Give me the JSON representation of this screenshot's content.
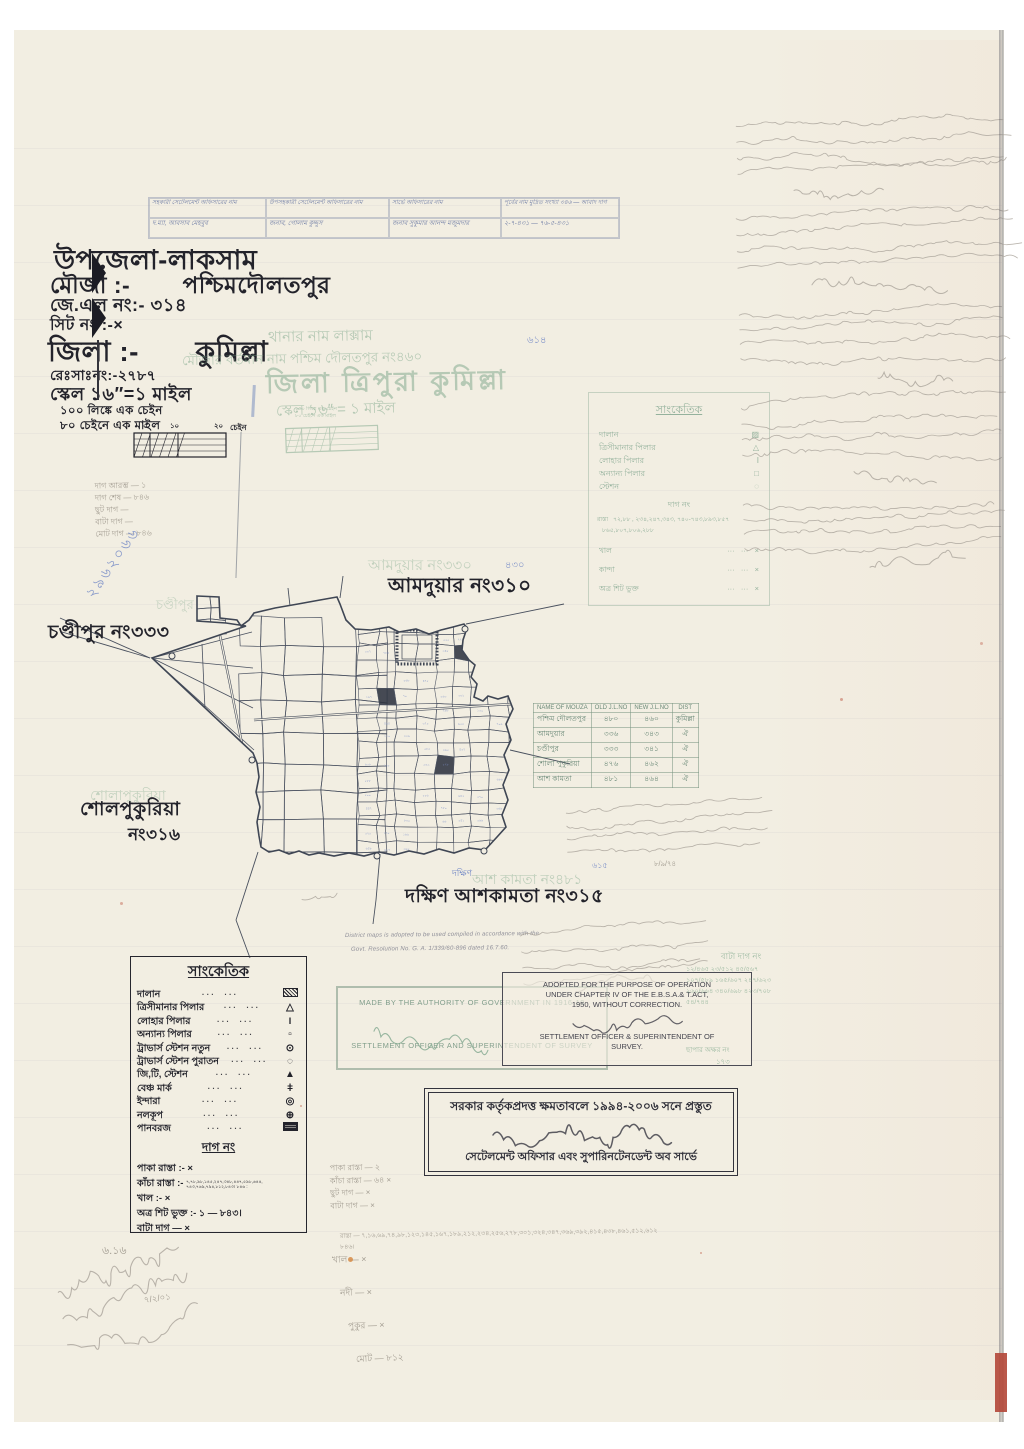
{
  "scan": {
    "paper_color": "#f2eee2",
    "stamp_green": "#7ca689",
    "ink_blue": "#6b82c4",
    "pencil_gray": "#a39d92"
  },
  "top_table": {
    "headers": [
      "সহকারী সেটেলমেন্ট অফিসারের নাম",
      "উপসহকারী সেটেলমেন্ট অফিসারের নাম",
      "সার্ভে অফিসারের নাম",
      "পূর্বের নাম মুদ্রিত সংখ্যা ৩৪৬ — আবাদ দাগ"
    ],
    "row": [
      "দ.ম্যা, আবসাব মেহবুব",
      "জনাব, গোলাম কুদ্দুস",
      "জনাব সুকুমার আনন্দ মজুমদার",
      "২-৭-৪৩১ — ৭৬-৫-৪৩১"
    ]
  },
  "title_block": {
    "upazila": "উপজেলা-লাকসাম",
    "mouza_label": "মৌজা :-",
    "mouza_name": "পশ্চিমদৌলতপুর",
    "jl_no": "জে.এল নং:-  ৩১৪",
    "sheet_no": "সিট নং :-×",
    "district_label": "জিলা :-",
    "district_name": "কুমিল্লা",
    "rs_no": "রেঃসাঃনং:-২৭৮৭",
    "scale": "স্কেল ১৬″=১ মাইল",
    "chain_note": "১০০ লিঙ্কে এক চেইন",
    "mile_note": "৮০ চেইনে এক মাইল",
    "scalebar": {
      "tick_start": "০",
      "tick_mid": "১০",
      "tick_end": "২০",
      "unit": "চেইন"
    }
  },
  "green_overprint": {
    "thana": "থানার নাম লাক্সাম",
    "mouza": "মৌজার বর্তমান নাম পশ্চিম দৌলতপুর নং৪৬০",
    "district": "জিলা ত্রিপুরা কুমিল্লা",
    "scale": "স্কেল ১৬″ = ১ মাইল",
    "chain_note": "১০০ লিঙ্কে এক চেইন",
    "mile_note": "৮০ চেইনে এক মাইল",
    "blue_mark": "৬১৪"
  },
  "map": {
    "neighbors": {
      "north": "আমদুয়ার নং৩১০",
      "north_stamp": "আমদুয়ার নং৩৩০",
      "north_blue": "৪৩০",
      "west": "চণ্ডীপুর নং৩৩৩",
      "west_stamp": "চণ্ডীপুর",
      "southwest_1": "শোলপুকুরিয়া",
      "southwest_2": "নং৩১৬",
      "southwest_stamp": "শোলাপুকুরিয়া",
      "south": "দক্ষিণ আশকামতা নং৩১৫",
      "south_stamp": "আশ কামতা নং৪৮১",
      "south_blue": "দক্ষিণ",
      "south_blue2": "৬১৫"
    }
  },
  "mouza_table": {
    "headers": [
      "NAME OF MOUZA",
      "OLD J.L.NO",
      "NEW J.L.NO",
      "DIST"
    ],
    "rows": [
      [
        "পশ্চিম দৌলতপুর",
        "৪৮০",
        "৪৬০",
        "কুমিল্লা"
      ],
      [
        "আমদুয়ার",
        "৩৩৬",
        "৩৪৩",
        "ঐ"
      ],
      [
        "চণ্ডীপুর",
        "৩৩৩",
        "৩৪১",
        "ঐ"
      ],
      [
        "শোলা পুকুরিয়া",
        "৪৭৬",
        "৪৬২",
        "ঐ"
      ],
      [
        "আশ কামতা",
        "৪৮১",
        "৪৬৪",
        "ঐ"
      ]
    ]
  },
  "green_legend": {
    "title": "সাংকেতিক",
    "items": [
      {
        "label": "দালান",
        "symbol": "▨"
      },
      {
        "label": "ত্রিসীমানার পিলার",
        "symbol": "△"
      },
      {
        "label": "লোহার পিলার",
        "symbol": "I"
      },
      {
        "label": "অন্যান্য পিলার",
        "symbol": "□"
      },
      {
        "label": "স্টেশন",
        "symbol": "◌"
      }
    ],
    "dag_title": "দাগ নং",
    "rasta_label": "রাস্তা",
    "rasta_line1": "৭২,৮৮ , ২৩৪,২৪৭,৩৪৩, ৭৪০-৭৪৩,৮৯৩,৮৫৭",
    "rasta_line2": "৮৬৫,৮০৭,৮০৬,২৮৮",
    "rows": [
      [
        "খাল",
        "×"
      ],
      [
        "কান্দা",
        "×"
      ],
      [
        "অত্র শিট ভুক্ত",
        "×"
      ]
    ]
  },
  "legend": {
    "title": "সাংকেতিক",
    "items": [
      {
        "label": "দালান",
        "symbol": "hatch-box"
      },
      {
        "label": "ত্রিসীমানার পিলার",
        "symbol": "triangle-outline"
      },
      {
        "label": "লোহার পিলার",
        "symbol": "bar"
      },
      {
        "label": "অন্যান্য পিলার",
        "symbol": "square-outline"
      },
      {
        "label": "ট্রাভার্স স্টেশন নতুন",
        "symbol": "circle-dot"
      },
      {
        "label": "ট্রাভার্স স্টেশন পুরাতন",
        "symbol": "circle-dashed"
      },
      {
        "label": "জি,টি, স্টেশন",
        "symbol": "triangle-filled"
      },
      {
        "label": "বেঞ্চ মার্ক",
        "symbol": "benchmark"
      },
      {
        "label": "ইন্দারা",
        "symbol": "double-circle"
      },
      {
        "label": "নলকূপ",
        "symbol": "circle-cross"
      },
      {
        "label": "পানবরজ",
        "symbol": "hatch-box-dense"
      }
    ],
    "dag_title": "দাগ নং",
    "dag_items": [
      {
        "label": "পাকা রাস্তা :-",
        "value": "×",
        "small": false
      },
      {
        "label": "কাঁচা রাস্তা :-",
        "value": "৭,৭৮,৯৮,১৪৫,২৪৭,৩৪৮,৪৪৭,৫৯৮,৬৪৪, ৭৪৩,৭৬৯,৭৯৪,৮১২,৮৪৩। ৮৪৬ :",
        "small": true
      },
      {
        "label": "খাল :-",
        "value": "×",
        "small": false
      },
      {
        "label": "অত্র শিট ভুক্ত :-",
        "value": "১ — ৮৪৩।",
        "small": false
      },
      {
        "label": "বাটা দাগ",
        "value": "— ×",
        "small": false
      }
    ]
  },
  "stamps": {
    "made_by": {
      "line1": "MADE BY THE AUTHORITY OF GOVERNMENT IN  1916-19",
      "line2": "SETTLEMENT OFFICER AND SUPERINTENDENT OF SURVEY"
    },
    "adopted": {
      "line1": "ADOPTED FOR THE PURPOSE OF OPERATION",
      "line2": "UNDER CHAPTER IV OF THE E.B.S.A.& T.ACT,",
      "line3": "1950, WITHOUT CORRECTION.",
      "line4": "SETTLEMENT OFFICER & SUPERINTENDENT OF",
      "line5": "SURVEY."
    },
    "resolution_1": "District maps is adopted to be used compiled in accordance with the",
    "resolution_2": "Govt. Resolution No. G. A. 1/339/60-896 dated 16.7.60.",
    "prepared": {
      "line1": "সরকার কর্তৃকপ্রদত্ত ক্ষমতাবলে ১৯৯৪-২০০৬ সনে প্রস্তুত",
      "line2": "সেটেলমেন্ট অফিসার এবং সুপারিনটেনডেন্ট অব সার্ভে"
    },
    "bata": {
      "title": "বাটা দাগ নং",
      "rows": [
        "১২/৪৬৫  ২৩/৫১২  ৪৫/৫৬৭",
        "১০৭/৫৮৯  ১৬৫/৬০৭  ২৪৭/৬২৩",
        "২৬০/৬৬৪  ৩৪০/৬৯৮  ৪২৩/৭০৮",
        "৫৪/৭৪৪"
      ],
      "footer": "ছাপার অক্ষর নং",
      "footer_value": "১৭৩"
    }
  },
  "pencil": {
    "left_list": [
      "দাগ আরম্ভ —  ১",
      "দাগ শেষ — ৮৪৬",
      "ছুট দাগ —",
      "বাটা দাগ —",
      "মোট দাগ — ৮৪৬"
    ],
    "blue_diagonal": "২৯৬২০৬৬",
    "bottom_list_a": [
      "পাকা রাস্তা — ২",
      "কাঁচা রাস্তা — ৬৪ ×",
      "ছুট দাগ — ×",
      "বাটা দাগ — ×"
    ],
    "bottom_long_line": "রাস্তা — ৭,১৬,৬৯,৭৪,৯৮,১২৩,১৪৫,১৬৭,১৮৯,২১২,২৩৪,২৫৬,২৭৮,৩০১,৩২৪,৩৪৭,৩৬৯,৩৯২,৪১৫,৪৩৮,৪৬১,৫১২,৬১২  ৮৪৬।",
    "bottom_list_b": [
      "খাল — ×",
      "নদী — ×",
      "পুকুর — ×",
      "মোট — ৮১২"
    ],
    "corner_note": "৬.১৬",
    "corner_date": "৭/২/০১",
    "table_note_date": "৮/৯/৭৪"
  },
  "marginalia": {
    "description": "অস্পষ্ট পেন্সিল মন্তব্য (illegible pencil notes)",
    "blocks": 5,
    "signatures": 4
  }
}
